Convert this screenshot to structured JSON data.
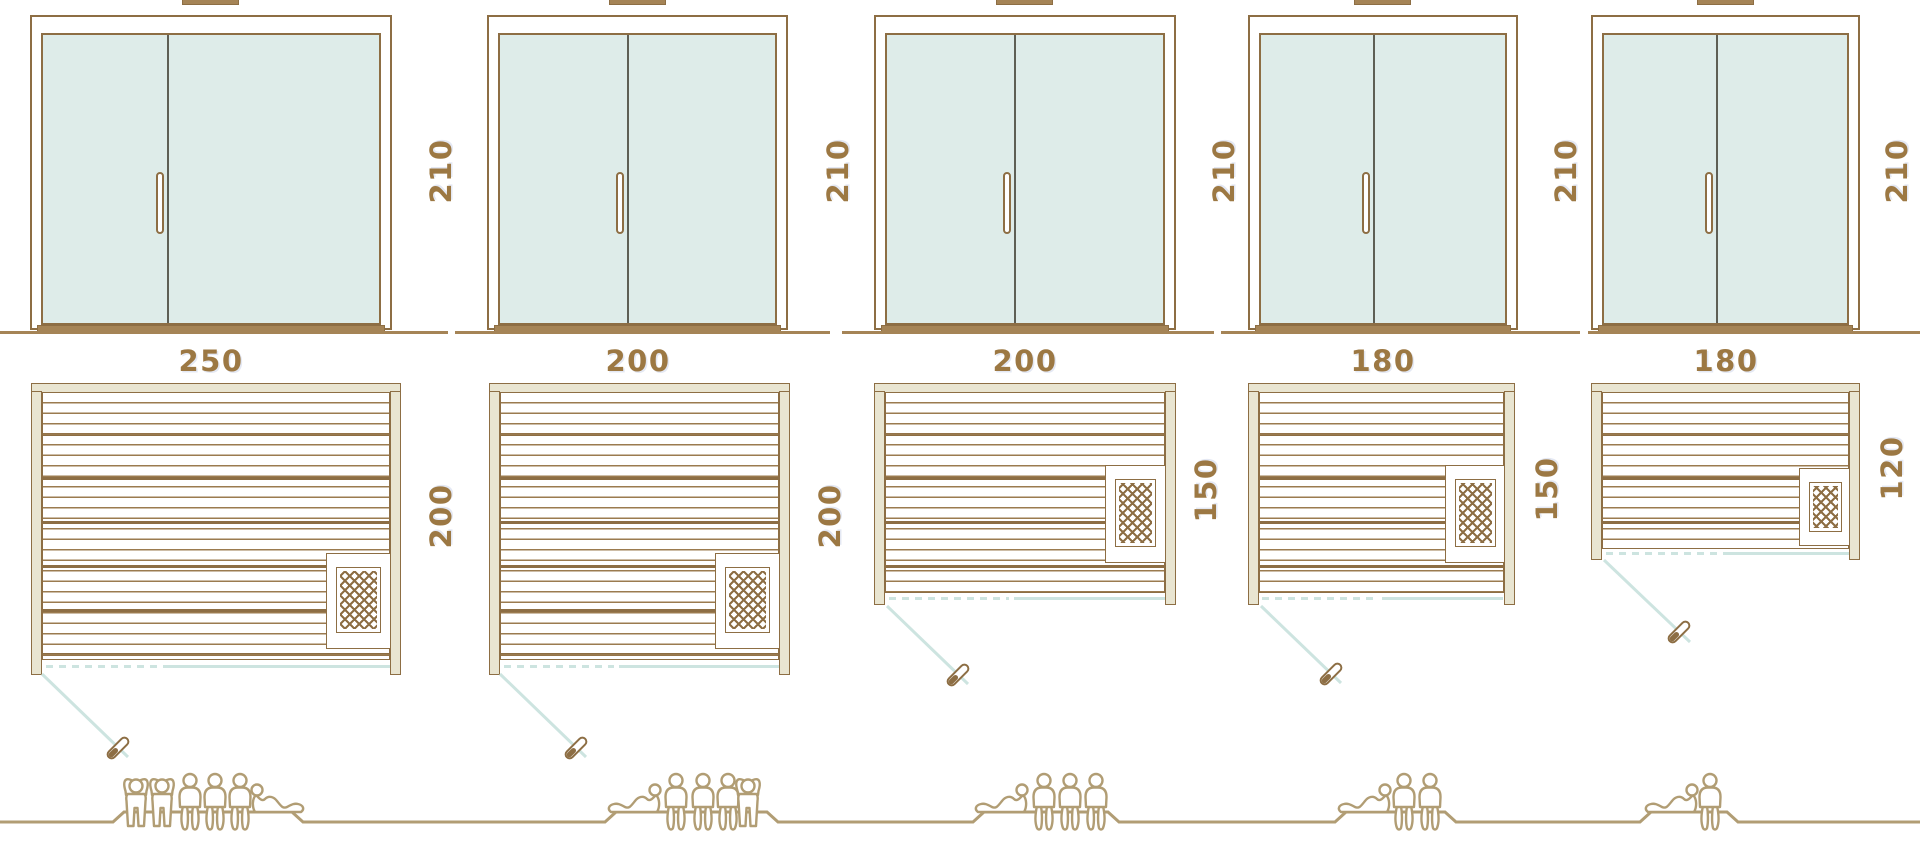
{
  "diagram": {
    "subject": "sauna size comparison diagram",
    "views": [
      "front-elevation",
      "floor-plan",
      "capacity-figures"
    ]
  },
  "palette": {
    "line_brown": "#8d6e44",
    "wall_fill": "#e9e5d1",
    "glass_mint": "#deece9",
    "threshold_brown": "#a58456",
    "label_brown": "#9c7843",
    "door_swing_teal": "#cde4e0",
    "people_tan": "#b19d74",
    "door_split_dark": "#5e5f55"
  },
  "units": [
    {
      "width_label": "250",
      "height_label": "210",
      "depth_label": "200",
      "capacity": 6
    },
    {
      "width_label": "200",
      "height_label": "210",
      "depth_label": "200",
      "capacity": 5
    },
    {
      "width_label": "200",
      "height_label": "210",
      "depth_label": "150",
      "capacity": 4
    },
    {
      "width_label": "180",
      "height_label": "210",
      "depth_label": "150",
      "capacity": 3
    },
    {
      "width_label": "180",
      "height_label": "210",
      "depth_label": "120",
      "capacity": 2
    }
  ],
  "people_row": {
    "groups": [
      {
        "figures": [
          "standing",
          "standing",
          "sitting",
          "sitting",
          "sitting",
          "lying"
        ],
        "count": 6
      },
      {
        "figures": [
          "lying",
          "sitting",
          "sitting",
          "sitting",
          "standing"
        ],
        "count": 5
      },
      {
        "figures": [
          "lying",
          "sitting",
          "sitting",
          "sitting"
        ],
        "count": 4
      },
      {
        "figures": [
          "lying",
          "sitting",
          "sitting"
        ],
        "count": 3
      },
      {
        "figures": [
          "lying",
          "sitting"
        ],
        "count": 2
      }
    ]
  },
  "icons": {
    "heater": "heater-icon",
    "door_swing": "door-swing",
    "door_handle": "door-handle-icon",
    "roof_vent": "roof-vent-icon",
    "standing_person": "standing-person-icon",
    "sitting_person": "sitting-person-icon",
    "lying_person": "lying-person-icon"
  }
}
